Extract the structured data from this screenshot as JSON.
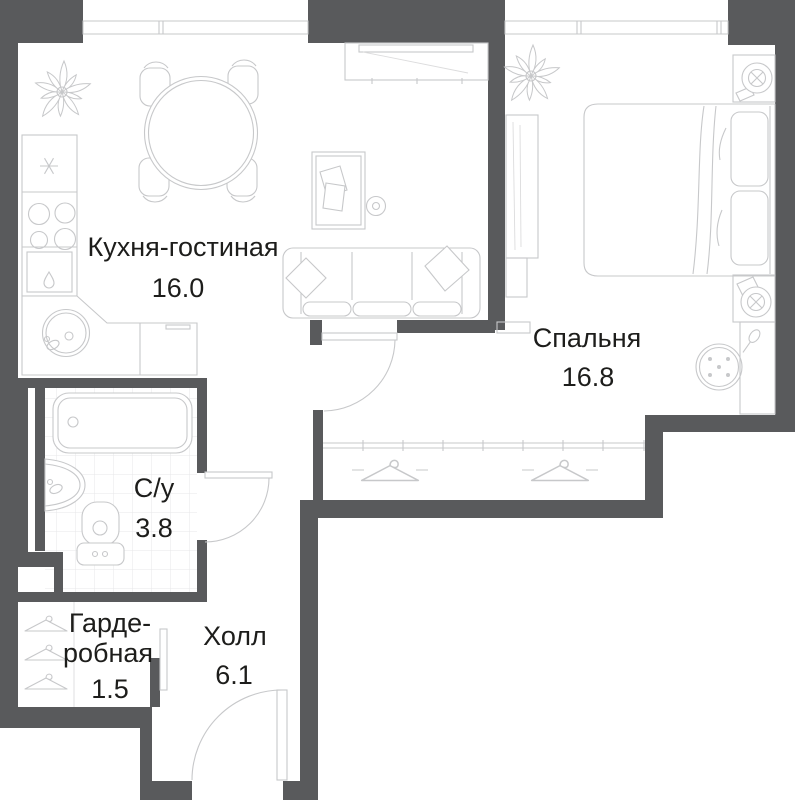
{
  "page": {
    "type": "apartment-floor-plan",
    "background": "#ffffff"
  },
  "colors": {
    "wall": "#595a5c",
    "line": "#c7c8ca",
    "line_soft": "#dcdcdd",
    "tile": "#e7e7e8",
    "text": "#1d1d1b"
  },
  "rooms": {
    "kitchen_living": {
      "label": "Кухня-гостиная",
      "area": "16.0"
    },
    "bedroom": {
      "label": "Спальня",
      "area": "16.8"
    },
    "bathroom": {
      "label": "С/у",
      "area": "3.8"
    },
    "wardrobe": {
      "label_line1": "Гарде-",
      "label_line2": "робная",
      "area": "1.5"
    },
    "hall": {
      "label": "Холл",
      "area": "6.1"
    }
  },
  "icons": {
    "plant-icon": "potted-plant-top-view",
    "hanger-icon": "clothes-hanger",
    "table-lamp-icon": "circle-with-cross-lamp",
    "snowflake-icon": "fridge-freezer-mark",
    "droplet-icon": "dishwasher-mark",
    "spoon-icon": "decor-spoon-mark"
  }
}
